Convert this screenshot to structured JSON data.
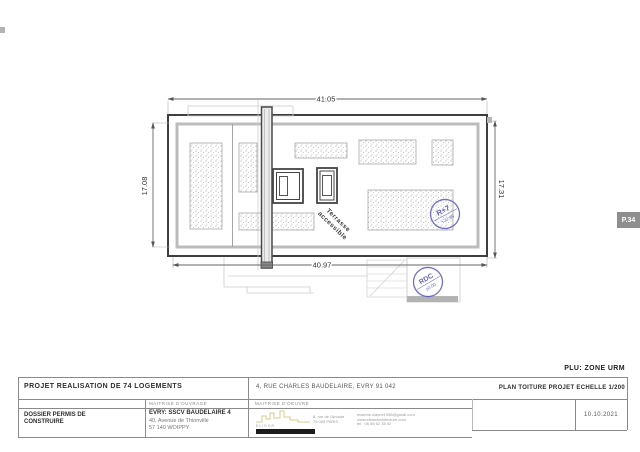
{
  "drawing": {
    "dimensions": {
      "top": "41.05",
      "left": "17.08",
      "right": "17.31",
      "bottom": "40.97"
    },
    "terrace_label": {
      "line1": "Terrasse",
      "line2": "accessible"
    },
    "stamps": {
      "roof": {
        "line1": "R+7",
        "line2": "+22.86"
      },
      "ground": {
        "line1": "RDC",
        "line2": "±0.00"
      }
    }
  },
  "page_tab": {
    "label": "P.34"
  },
  "plu_note": "PLU: ZONE URM",
  "title_block": {
    "project_title": "PROJET REALISATION DE 74 LOGEMENTS",
    "address": "4, RUE CHARLES BAUDELAIRE, EVRY  91 042",
    "plan_title": "PLAN TOITURE PROJET ECHELLE 1/200",
    "dossier": {
      "line1": "DOSSIER PERMIS DE",
      "line2": "CONSTRUIRE"
    },
    "maitrise_ouvrage": {
      "header": "MAITRISE D'OUVRAGE",
      "name": "EVRY: SSCV BAUDELAIRE 4",
      "address_line1": "40, Avenue de Thionville",
      "address_line2": "57 140 WOIPPY"
    },
    "maitrise_oeuvre": {
      "header": "MAITRISE D'OEUVRE",
      "logo_text": "ELIDOR",
      "contact_col1": [
        "8, rue de l'Arcade",
        "75 009 PARIS"
      ],
      "contact_col2": [
        "maxime.clayne1958@gmail.com",
        "www.elidorarchitecture.com",
        "tel : 06 66 62 35 02"
      ]
    },
    "date": "10.10.2021"
  },
  "colors": {
    "stamp_blue": "#4b48b0",
    "line_dark": "#3e3e3e",
    "line_grey": "#bcbcbc",
    "tab_grey": "#8e8e8e"
  }
}
